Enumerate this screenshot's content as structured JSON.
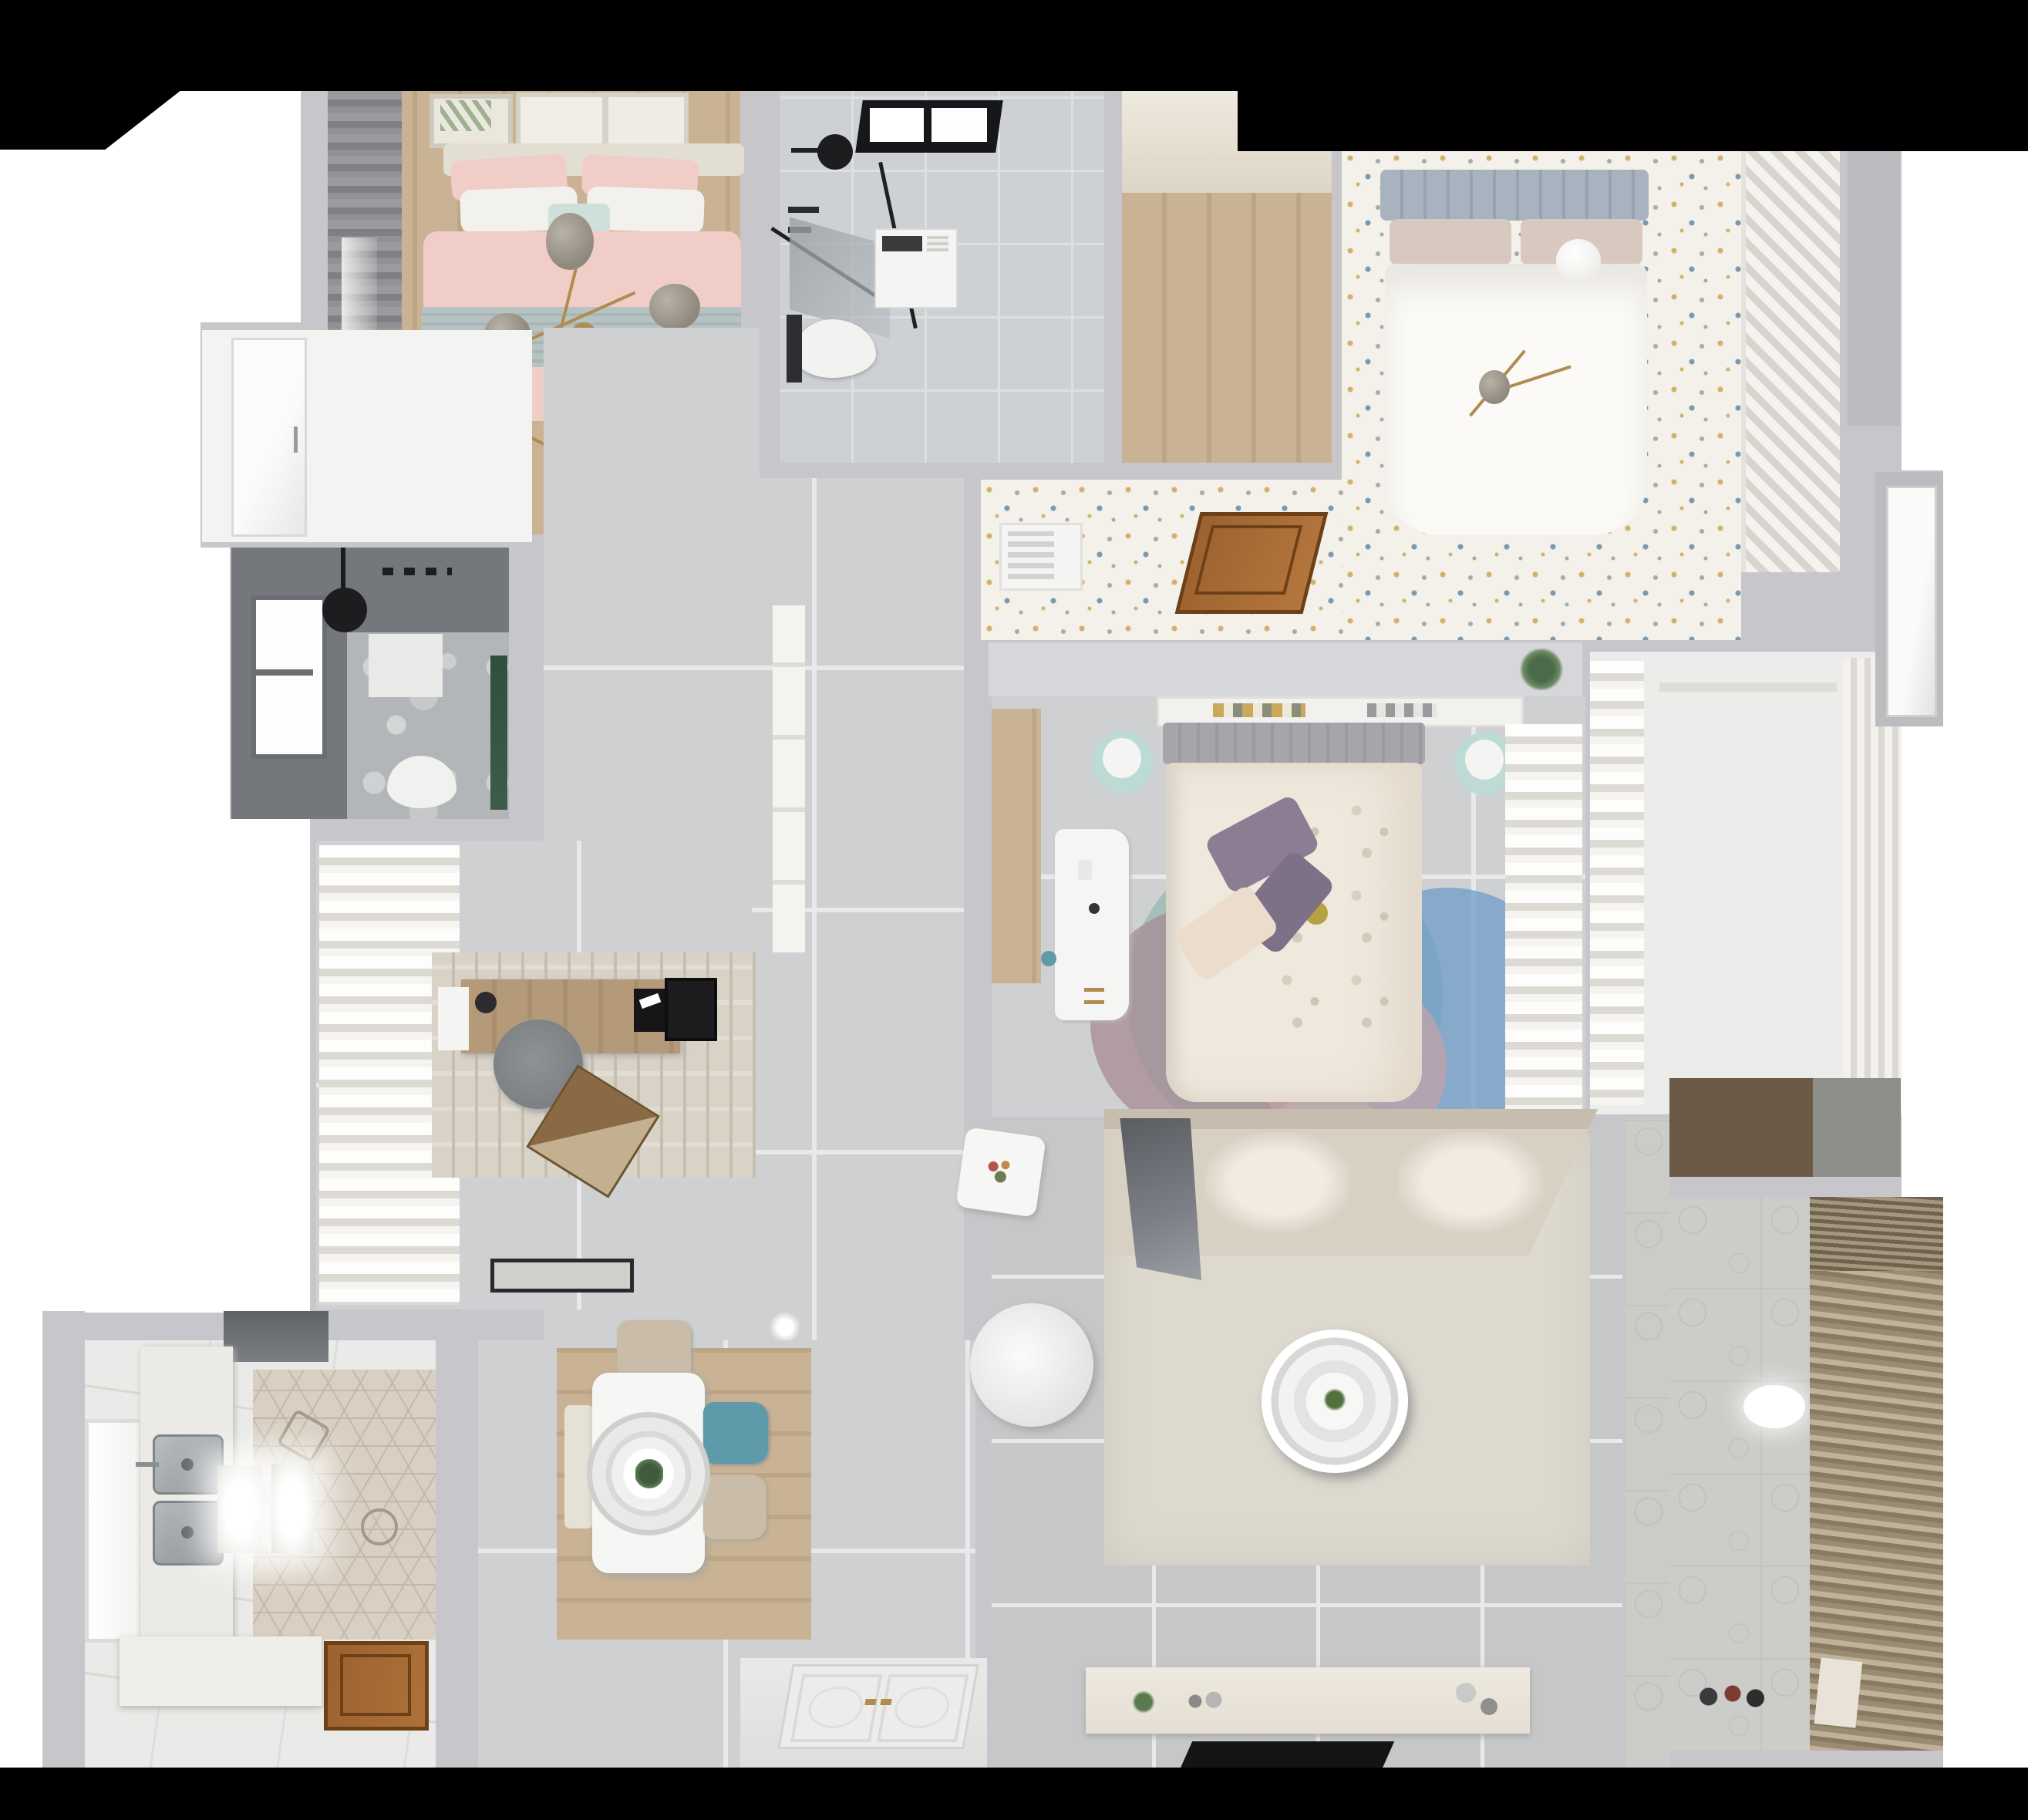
{
  "scene": {
    "type": "3d-apartment-floor-plan-top-down-render",
    "description": "Photorealistic bird's-eye 3D render of a furnished apartment floor plan on a white background with black cropped bands at top and bottom",
    "rooms": [
      {
        "id": "bedroom-pink",
        "label": "bedroom with pink bedding",
        "furniture": [
          "double-bed",
          "pink-duvet",
          "blue-folded-blanket",
          "pillows",
          "branch-chandelier",
          "gray-curtain",
          "wall-art-frames",
          "radiator"
        ]
      },
      {
        "id": "bathroom-top",
        "label": "bathroom with shower and washer",
        "furniture": [
          "skylight",
          "ceiling-shower",
          "glass-screen",
          "washing-machine",
          "toilet"
        ]
      },
      {
        "id": "closet-room",
        "label": "empty wood-floor room",
        "furniture": []
      },
      {
        "id": "bedroom-white",
        "label": "bedroom with speckled floor",
        "furniture": [
          "double-bed",
          "tufted-headboard",
          "ball-lamp",
          "art-card",
          "diagonal-slat-wardrobe",
          "open-wood-door",
          "air-vent",
          "plant-shelf"
        ]
      },
      {
        "id": "bedroom-middle",
        "label": "middle bedroom",
        "furniture": [
          "double-bed",
          "floral-duvet",
          "purple-pillows",
          "book-shelf",
          "white-desk",
          "mint-stools",
          "circle-rug",
          "sheer-curtain",
          "wood-strip"
        ]
      },
      {
        "id": "walk-in-closet",
        "label": "walk-in closet",
        "furniture": [
          "sheer-curtain",
          "vertical-shelving"
        ]
      },
      {
        "id": "study",
        "label": "study",
        "furniture": [
          "wood-desk",
          "monitor",
          "office-chair",
          "laptop",
          "textured-rug",
          "sheer-curtain",
          "doormat",
          "desk-art"
        ]
      },
      {
        "id": "bathroom-dark",
        "label": "dark shower room",
        "furniture": [
          "window",
          "ceiling-shower-disc",
          "wall-niche",
          "toilet",
          "plant"
        ]
      },
      {
        "id": "kitchen",
        "label": "kitchen",
        "furniture": [
          "dark-appliance",
          "sink-counter",
          "double-steel-sink",
          "lit-island-panels",
          "lower-counter",
          "window",
          "hex-tile-floor",
          "wood-service-door"
        ]
      },
      {
        "id": "dining",
        "label": "dining area",
        "furniture": [
          "white-table",
          "ring-pendant-lamp",
          "beige-chair",
          "teal-chair",
          "bench",
          "wood-runner"
        ]
      },
      {
        "id": "living",
        "label": "living room",
        "furniture": [
          "corner-sofa",
          "gray-throw",
          "round-coffee-table",
          "white-armchair",
          "plant-side-table",
          "tv-console",
          "tv-panel",
          "cream-rug"
        ]
      },
      {
        "id": "entry",
        "label": "entry",
        "furniture": [
          "double-entry-door-panels",
          "gold-handles"
        ]
      },
      {
        "id": "balcony",
        "label": "balcony laundry",
        "furniture": [
          "louvered-blind",
          "oval-ceiling-light",
          "toys",
          "paper-bag",
          "patterned-tile-floor"
        ]
      },
      {
        "id": "storage-niche",
        "label": "storage niche",
        "furniture": [
          "dark-wood-shelf"
        ]
      },
      {
        "id": "hall",
        "label": "hallway and corridor",
        "furniture": [
          "white-door",
          "tall-white-cabinet",
          "right-side-door"
        ]
      }
    ]
  },
  "colors": {
    "page": "#ffffff",
    "black": "#000000",
    "wall": "#c7c7cb",
    "wallDark": "#bcbcc0",
    "wallLight": "#d7d7db",
    "tile": "#cfd0d2",
    "tileLiving": "#c5c7c9",
    "grout": "#e8e9eb",
    "whiteTile": "#eaeae8",
    "woodLight": "#cab294",
    "woodMid": "#bda685",
    "woodDesk": "#b49a79",
    "woodDark": "#6b5a46",
    "doorBrown": "#9c622f",
    "doorBrownDark": "#6e4018",
    "hexBase": "#d9d0c3",
    "hexLine": "#c4b9a8",
    "speckleBase": "#f3f1ea",
    "dotGold": "#d2b26a",
    "dotBlue": "#7a99af",
    "dotGray": "#a9a9a5",
    "marble": "#b3b6b8",
    "bathDark": "#74777c",
    "sofa": "#d8d0c3",
    "sofaLit": "#f1ebe1",
    "throw": "#6e7177",
    "rugLiving": "#ddd9cf",
    "rugStudy": "#d9d3c7",
    "bedPink": "#f0cdc7",
    "blanketBlue": "#b7c2c3",
    "pillowWhite": "#f3f1ee",
    "pillowTeal": "#cfe0da",
    "sheer": "#f5f4f1",
    "sheerShade": "#dddad4",
    "headboard2": "#a9b2bf",
    "duvetWhite": "#fbfaf7",
    "pillowBeige": "#d9c8c0",
    "duvet3": "#efe8dd",
    "purple": "#8c7d92",
    "headboard3": "#a6a6aa",
    "mint": "#bedad5",
    "rugTeal": "#9cbcb6",
    "rugMauve": "#a88f96",
    "rugBlue": "#6f9cc8",
    "rugPink": "#c7a3a6",
    "tableWhite": "#f6f6f4",
    "chairTeal": "#5e9aa9",
    "chairBeige": "#c9bca9",
    "pendant": "#ebebe9",
    "steel": "#9fa4a8",
    "gold": "#b08c50",
    "globe": "#8f887d",
    "plant": "#4c6b4a",
    "louverA": "#9a8b73",
    "louverB": "#c0b29a",
    "balconyFloor": "#ccccc8",
    "consoleCream": "#e4ded4",
    "tvBlack": "#141414",
    "glow": "#ffffff"
  }
}
